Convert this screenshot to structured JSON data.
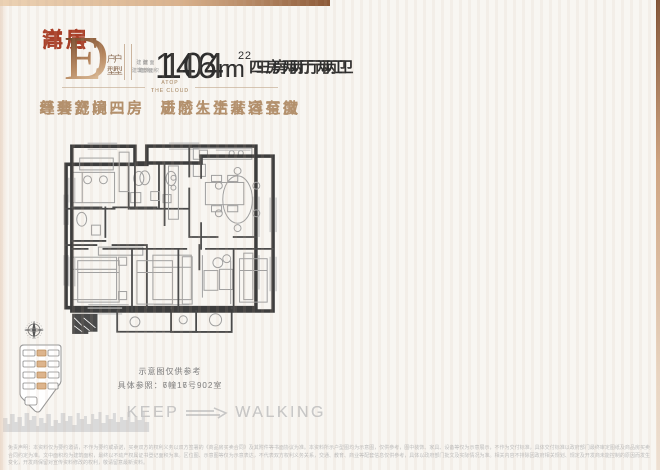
{
  "colors": {
    "accent_red": "#a93f28",
    "gold": "#b3906c",
    "band_light": "#ecd2b4",
    "band_dark": "#8d5a38",
    "site_highlight": "#ddb48c",
    "wall": "#3d3d3d"
  },
  "brand": {
    "line1": "ATOP",
    "line2": "THE CLOUD",
    "keep": "KEEP",
    "walking": "WALKING"
  },
  "panels": [
    {
      "category": "高层",
      "unit_letter": "D",
      "unit_type_label": "户型",
      "area_prefix_line1": "建 面",
      "area_prefix_line2": "建筑面积",
      "area_value": "104",
      "area_unit": "m",
      "area_sup": "2",
      "layout": "三房两厅两卫",
      "tagline_left": "经典舒阔三房",
      "tagline_right": "质感生活奢适至微",
      "note_line1": "示意图仅供参考",
      "note_line2": "具体参照：7幢16号902室"
    },
    {
      "category": "洋房",
      "unit_letter": "E",
      "unit_type_label": "户型",
      "area_prefix_line1": "建 面",
      "area_prefix_line2": "建筑面积",
      "area_value": "146",
      "area_unit": "m",
      "area_sup": "2",
      "layout": "四房两厅两卫",
      "tagline_left": "尊奢宽境四房",
      "tagline_right": "进阶人生从容有度",
      "note_line1": "示意图仅供参考",
      "note_line2": "具体参照：6幢17号902室"
    }
  ],
  "footer": {
    "disclaimer": "免责声明：本资料仅为要约邀请，不作为要约或承诺，买卖双方的权利义务以双方签署的《商品房买卖合同》及其附件等书面协议为准。本资料所示户型图均为示意图，仅供参考，图中装饰、家具、设备等仅为示意展示，不作为交付标准，具体交付标准以政府部门最终审定图纸及商品房买卖合同约定为准。文中面积均为建筑面积，最终以不动产权属证书登记面积为准。区位图、示意图等仅为示意表达，不代表双方权利义务关系，交通、教育、商业等配套信息仅供参考，具体以政府部门批文及实际情况为准。相关内容不排除因政府相关规划、规定及开发商未能控制的原因而发生变化，开发商保留对宣传资料修改的权利，敬请留意最新资料。"
  }
}
